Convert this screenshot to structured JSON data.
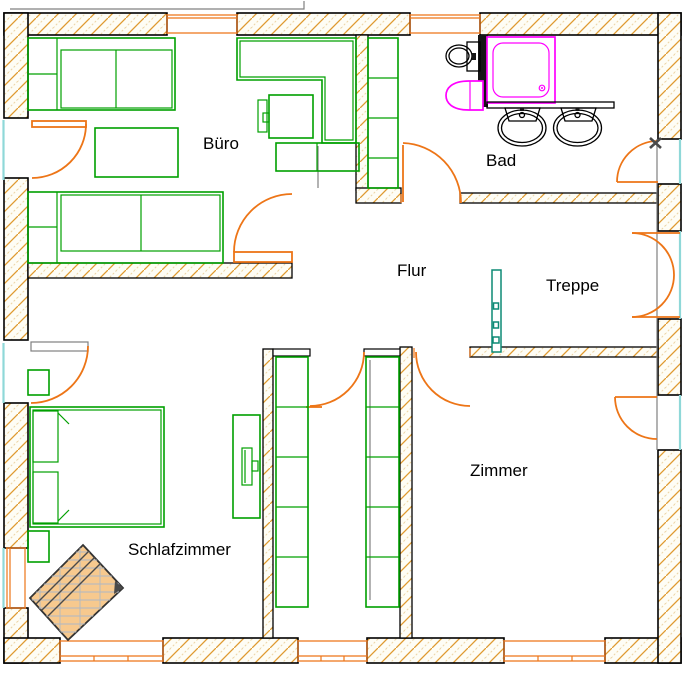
{
  "floorplan": {
    "rooms": {
      "buero": {
        "label": "Büro"
      },
      "bad": {
        "label": "Bad"
      },
      "flur": {
        "label": "Flur"
      },
      "treppe": {
        "label": "Treppe"
      },
      "zimmer": {
        "label": "Zimmer"
      },
      "schlafzimmer": {
        "label": "Schlafzimmer"
      }
    },
    "marker": {
      "symbol": "x-point-marker"
    },
    "colors": {
      "wall_hatch_orange": "#DF9A30",
      "wall_hatch_pale": "#EDD4A4",
      "furniture_green": "#00A000",
      "fixture_magenta": "#FF00FF",
      "door_orange": "#ED7517",
      "glazing_cyan": "#8FD8D8",
      "construction_gray": "#808080",
      "door_leaf_teal": "#0D8A75",
      "dresser_fill_tan": "#F7C98E",
      "marker_gray": "#4A4A4A"
    }
  }
}
